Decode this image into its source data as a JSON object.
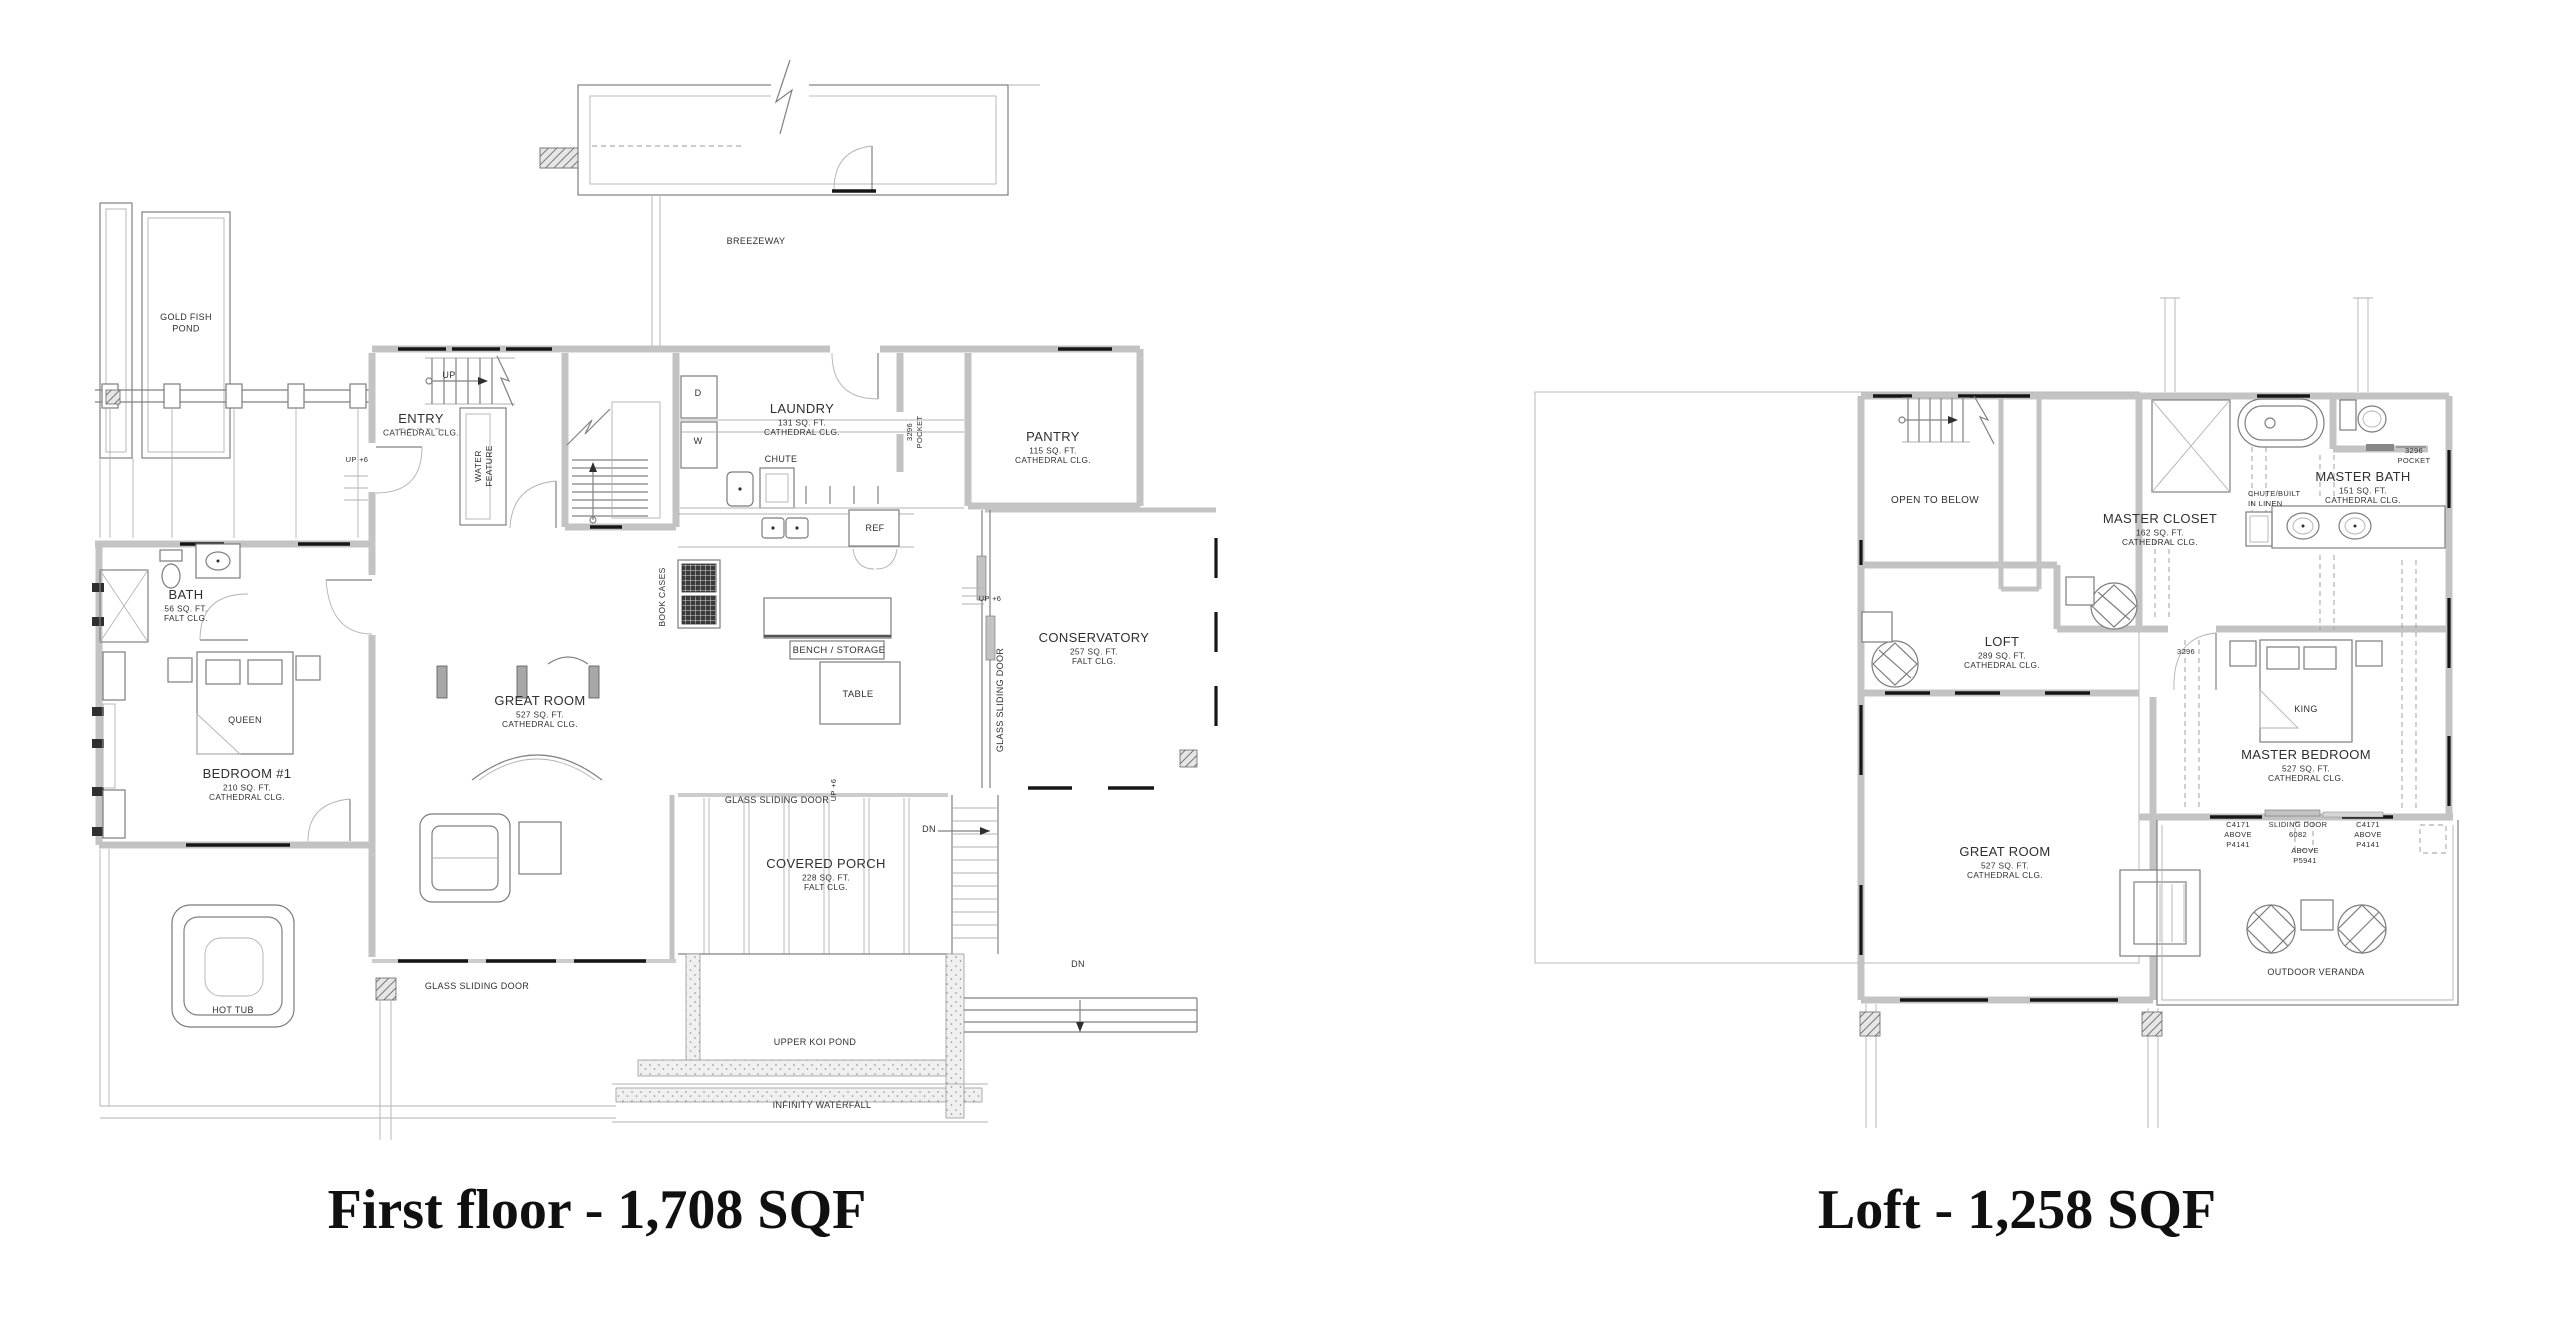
{
  "colors": {
    "wall_gray": "#c3c3c3",
    "window_black": "#161616",
    "line_gray": "#808080",
    "text": "#2f2f2f",
    "background": "#ffffff"
  },
  "plans": [
    {
      "id": "first-floor",
      "title": "First floor - 1,708 SQF",
      "rooms": [
        {
          "name": "ENTRY",
          "x": 421,
          "y": 423,
          "subs": [
            "CATHEDRAL CLG."
          ]
        },
        {
          "name": "LAUNDRY",
          "x": 802,
          "y": 413,
          "subs": [
            "131 SQ. FT.",
            "CATHEDRAL CLG."
          ]
        },
        {
          "name": "PANTRY",
          "x": 1053,
          "y": 441,
          "subs": [
            "115 SQ. FT.",
            "CATHEDRAL CLG."
          ]
        },
        {
          "name": "BATH",
          "x": 186,
          "y": 599,
          "subs": [
            "56 SQ. FT.",
            "FALT CLG."
          ]
        },
        {
          "name": "BEDROOM #1",
          "x": 247,
          "y": 778,
          "subs": [
            "210 SQ. FT.",
            "CATHEDRAL CLG."
          ]
        },
        {
          "name": "GREAT ROOM",
          "x": 540,
          "y": 705,
          "subs": [
            "527 SQ. FT.",
            "CATHEDRAL CLG."
          ]
        },
        {
          "name": "CONSERVATORY",
          "x": 1094,
          "y": 642,
          "subs": [
            "257 SQ. FT.",
            "FALT CLG."
          ]
        },
        {
          "name": "COVERED PORCH",
          "x": 826,
          "y": 868,
          "subs": [
            "228 SQ. FT.",
            "FALT CLG."
          ]
        }
      ],
      "notes": [
        {
          "lines": [
            "BREEZEWAY"
          ],
          "x": 756,
          "y": 244,
          "fs": 9
        },
        {
          "lines": [
            "GOLD FISH",
            "POND"
          ],
          "x": 186,
          "y": 320,
          "fs": 9
        },
        {
          "lines": [
            "UP"
          ],
          "x": 449,
          "y": 378,
          "fs": 9
        },
        {
          "lines": [
            "UP +6"
          ],
          "x": 357,
          "y": 462,
          "fs": 7.5
        },
        {
          "lines": [
            "UP +6"
          ],
          "x": 990,
          "y": 601,
          "fs": 7.5
        },
        {
          "lines": [
            "UP +6"
          ],
          "x": 836,
          "y": 790,
          "fs": 7.5,
          "rot": -90
        },
        {
          "lines": [
            "WATER",
            "FEATURE"
          ],
          "x": 481,
          "y": 466,
          "fs": 8.5,
          "rot": -90
        },
        {
          "lines": [
            "D"
          ],
          "x": 698,
          "y": 396,
          "fs": 9
        },
        {
          "lines": [
            "W"
          ],
          "x": 698,
          "y": 444,
          "fs": 9
        },
        {
          "lines": [
            "CHUTE"
          ],
          "x": 781,
          "y": 462,
          "fs": 9
        },
        {
          "lines": [
            "3296",
            "POCKET"
          ],
          "x": 912,
          "y": 432,
          "fs": 7.5,
          "rot": -90
        },
        {
          "lines": [
            "REF"
          ],
          "x": 875,
          "y": 531,
          "fs": 9
        },
        {
          "lines": [
            "BOOK CASES"
          ],
          "x": 665,
          "y": 597,
          "fs": 8.5,
          "rot": -90
        },
        {
          "lines": [
            "BENCH / STORAGE"
          ],
          "x": 839,
          "y": 653,
          "fs": 9.5
        },
        {
          "lines": [
            "TABLE"
          ],
          "x": 858,
          "y": 697,
          "fs": 9.5
        },
        {
          "lines": [
            "QUEEN"
          ],
          "x": 245,
          "y": 723,
          "fs": 9
        },
        {
          "lines": [
            "GLASS SLIDING DOOR"
          ],
          "x": 1003,
          "y": 700,
          "fs": 9,
          "rot": -90
        },
        {
          "lines": [
            "GLASS SLIDING DOOR"
          ],
          "x": 777,
          "y": 803,
          "fs": 9
        },
        {
          "lines": [
            "GLASS SLIDING DOOR"
          ],
          "x": 477,
          "y": 989,
          "fs": 9
        },
        {
          "lines": [
            "DN"
          ],
          "x": 929,
          "y": 832,
          "fs": 9
        },
        {
          "lines": [
            "DN"
          ],
          "x": 1078,
          "y": 967,
          "fs": 9
        },
        {
          "lines": [
            "HOT TUB"
          ],
          "x": 233,
          "y": 1013,
          "fs": 9
        },
        {
          "lines": [
            "UPPER KOI POND"
          ],
          "x": 815,
          "y": 1045,
          "fs": 9
        },
        {
          "lines": [
            "INFINITY WATERFALL"
          ],
          "x": 822,
          "y": 1108,
          "fs": 9
        }
      ]
    },
    {
      "id": "loft",
      "title": "Loft - 1,258 SQF",
      "rooms": [
        {
          "name": "LOFT",
          "x": 2002,
          "y": 646,
          "subs": [
            "289 SQ. FT.",
            "CATHEDRAL CLG."
          ]
        },
        {
          "name": "MASTER CLOSET",
          "x": 2160,
          "y": 523,
          "subs": [
            "162 SQ. FT.",
            "CATHEDRAL CLG."
          ]
        },
        {
          "name": "MASTER BATH",
          "x": 2363,
          "y": 481,
          "subs": [
            "151 SQ. FT.",
            "CATHEDRAL CLG."
          ]
        },
        {
          "name": "MASTER BEDROOM",
          "x": 2306,
          "y": 759,
          "subs": [
            "527 SQ. FT.",
            "CATHEDRAL CLG."
          ]
        },
        {
          "name": "GREAT ROOM",
          "x": 2005,
          "y": 856,
          "subs": [
            "527 SQ. FT.",
            "CATHEDRAL CLG."
          ]
        }
      ],
      "notes": [
        {
          "lines": [
            "OPEN TO BELOW"
          ],
          "x": 1935,
          "y": 503,
          "fs": 10
        },
        {
          "lines": [
            "CHUTE/BUILT",
            "IN LINEN"
          ],
          "x": 2248,
          "y": 496,
          "fs": 7.5,
          "anchor": "start"
        },
        {
          "lines": [
            "3296",
            "POCKET"
          ],
          "x": 2414,
          "y": 453,
          "fs": 7.5
        },
        {
          "lines": [
            "3296"
          ],
          "x": 2186,
          "y": 654,
          "fs": 7.5
        },
        {
          "lines": [
            "KING"
          ],
          "x": 2306,
          "y": 712,
          "fs": 9
        },
        {
          "lines": [
            "C4171",
            "ABOVE",
            "P4141"
          ],
          "x": 2238,
          "y": 827,
          "fs": 7.5
        },
        {
          "lines": [
            "SLIDING DOOR",
            "6082"
          ],
          "x": 2298,
          "y": 827,
          "fs": 7.5
        },
        {
          "lines": [
            "ABOVE",
            "P5941"
          ],
          "x": 2305,
          "y": 853,
          "fs": 7.5
        },
        {
          "lines": [
            "C4171",
            "ABOVE",
            "P4141"
          ],
          "x": 2368,
          "y": 827,
          "fs": 7.5
        },
        {
          "lines": [
            "OUTDOOR VERANDA"
          ],
          "x": 2316,
          "y": 975,
          "fs": 9
        }
      ]
    }
  ]
}
